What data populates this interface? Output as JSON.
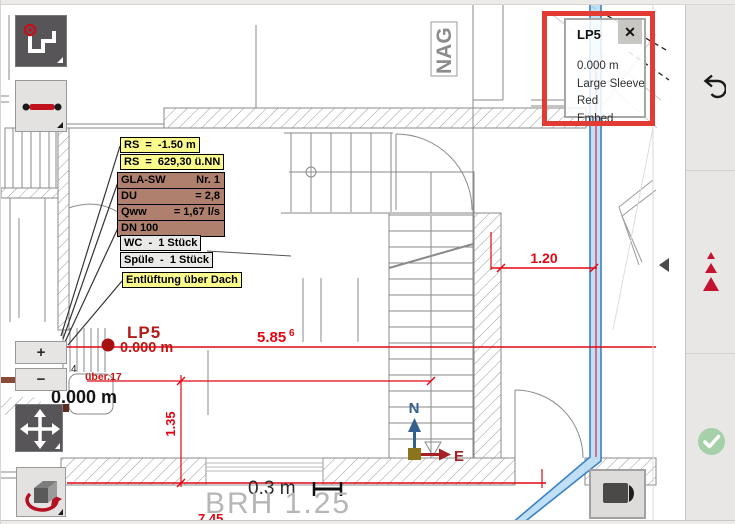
{
  "tooltip": {
    "title": "LP5",
    "close_label": "✕",
    "items": [
      "0.000 m",
      "Large Sleeve",
      "Red",
      "Embed"
    ]
  },
  "zoom_controls": {
    "zoom_in": "+",
    "zoom_out": "−"
  },
  "annotation_boxes": {
    "rs_depth": "RS  =  -1.50 m",
    "rs_level": "RS  =  629,30 ü.NN",
    "gla_rows": [
      {
        "label": "GLA-SW",
        "value": "Nr. 1"
      },
      {
        "label": "DU",
        "value": "= 2,8"
      },
      {
        "label": "Qww",
        "value": "= 1,67 l/s"
      },
      {
        "label": "DN 100",
        "value": ""
      }
    ],
    "wc": "WC  -  1 Stück",
    "sink": "Spüle  -  1 Stück",
    "vent": "Entlüftung über Dach"
  },
  "plan_labels": {
    "nag": "NAG",
    "lp5": "LP5",
    "lp5_level": "0.000 m",
    "level_note": "0.000 m",
    "level_scribble": "über.17",
    "tread_number": "4",
    "window_height": "BRH 1.25",
    "scale_value": "0.3 m",
    "north": "N",
    "east": "E"
  },
  "dimensions": {
    "horizontal_main": "5.85",
    "horizontal_main_sup": "6",
    "horizontal_right": "1.20",
    "vertical_left": "1.35",
    "bottom": "7.45"
  },
  "colors": {
    "highlight_red": "#e23b33",
    "dimension_red": "#e30613",
    "annotation_yellow": "#fbfb8d",
    "annotation_brown": "#b0806e",
    "pipe_blue": "#3b82c4",
    "pipe_fill": "#badbf4",
    "confirm_green": "#a6d0a9",
    "marker_red": "#c41230"
  }
}
